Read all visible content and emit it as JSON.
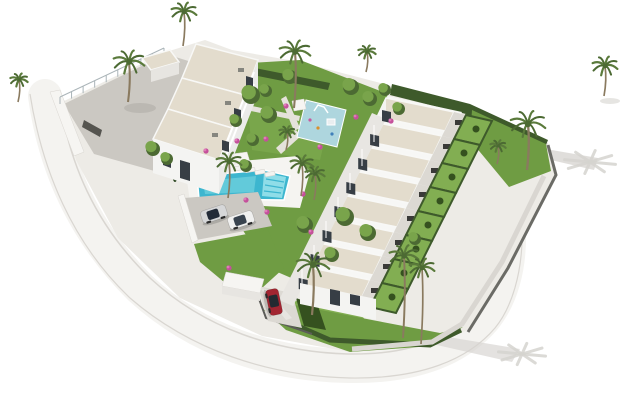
{
  "scene": {
    "description": "Aerial 3D architectural rendering of a white residential complex on a white background: a three-unit block at the top left, a diagonal row of eight townhouses with private hedged gardens on the right, a central landscaped garden with a children's playground, a turquoise communal swimming pool with sun loungers and a pergola, a grey parking area with two cars, an entrance carport with a red car, palm trees throughout, and a curved perimeter road casting palm shadows.",
    "inventory": {
      "block_a_units": 3,
      "townhouse_units": 8,
      "swimming_pools": 1,
      "playgrounds": 1,
      "cars": 3,
      "palm_trees": 15
    },
    "townhouse_row": {
      "count": 8
    },
    "block_a": {
      "units": 3
    },
    "forecourt": {
      "balustrade_posts": 10
    },
    "pool": {
      "loungers": 4
    },
    "palms": [
      [
        183,
        46,
        34,
        13
      ],
      [
        128,
        102,
        40,
        16
      ],
      [
        18,
        102,
        22,
        9
      ],
      [
        294,
        108,
        56,
        16
      ],
      [
        228,
        198,
        36,
        13
      ],
      [
        301,
        196,
        32,
        12
      ],
      [
        314,
        200,
        26,
        10
      ],
      [
        527,
        170,
        46,
        18
      ],
      [
        497,
        164,
        18,
        8
      ],
      [
        403,
        338,
        82,
        15
      ],
      [
        421,
        344,
        76,
        13
      ],
      [
        312,
        315,
        50,
        17
      ],
      [
        366,
        72,
        20,
        9
      ],
      [
        604,
        96,
        30,
        13
      ],
      [
        286,
        150,
        18,
        8
      ]
    ],
    "trees": [
      [
        250,
        94,
        9
      ],
      [
        268,
        114,
        8
      ],
      [
        289,
        76,
        7
      ],
      [
        350,
        86,
        8
      ],
      [
        369,
        98,
        7
      ],
      [
        304,
        224,
        8
      ],
      [
        344,
        216,
        9
      ],
      [
        367,
        232,
        8
      ],
      [
        252,
        139,
        6
      ],
      [
        384,
        89,
        6
      ],
      [
        331,
        254,
        7
      ],
      [
        414,
        238,
        6
      ],
      [
        152,
        148,
        7
      ],
      [
        166,
        158,
        6
      ],
      [
        398,
        108,
        6
      ],
      [
        265,
        90,
        6
      ],
      [
        235,
        120,
        6
      ],
      [
        245,
        165,
        6
      ]
    ],
    "flowers": [
      [
        237,
        141
      ],
      [
        266,
        139
      ],
      [
        320,
        147
      ],
      [
        303,
        194
      ],
      [
        206,
        151
      ],
      [
        229,
        268
      ],
      [
        286,
        106
      ],
      [
        356,
        117
      ],
      [
        391,
        121
      ],
      [
        267,
        212
      ],
      [
        246,
        200
      ],
      [
        311,
        232
      ]
    ],
    "cars": [
      {
        "name": "car-silver",
        "x": 214,
        "y": 214,
        "rot": -18,
        "body": "#d6d7d8",
        "glass": "#222b38"
      },
      {
        "name": "car-white",
        "x": 241,
        "y": 220,
        "rot": -18,
        "body": "#f0f0ef",
        "glass": "#39434e"
      },
      {
        "name": "car-red",
        "x": 274,
        "y": 302,
        "rot": 78,
        "body": "#a22531",
        "glass": "#242a31"
      }
    ]
  },
  "colors": {
    "background": "#ffffff",
    "road_surface": "#f4f3f0",
    "road_edge": "#d9d6d1",
    "site_base": "#edebe6",
    "paving": "#cbc8c2",
    "paving_light": "#dcd9d3",
    "path_grey": "#e5e2db",
    "wall_white": "#f6f5f2",
    "wall_face": "#e7e5e1",
    "gate_dark": "#55544f",
    "roof_beige": "#e3dccd",
    "roof_edge": "#f8f8f6",
    "facade_bright": "#f4f4f2",
    "facade_mid": "#ebebe9",
    "facade_low": "#e8e6e2",
    "window_dark": "#373e45",
    "lawn": "#6f9c43",
    "lawn_light": "#82ae52",
    "hedge_dark": "#3e5a2b",
    "bush_dark": "#35511f",
    "tree_dark": "#4c6a33",
    "tree_light": "#79a44b",
    "cypress": "#2e4823",
    "palm_green": "#5a7a3b",
    "palm_trunk": "#8a7a5f",
    "pool_water": "#3db6cf",
    "pool_light": "#6fd0de",
    "pool_shelf": "#8fdde8",
    "deck_white": "#f5f4f1",
    "playground_blue": "#aed6de",
    "stone_wall": "#b5a48a",
    "flower_pink": "#c4509b",
    "flower_light": "#e07ab8",
    "shadow_grey": "#d5d3cf",
    "boundary_wall": "#6b6b66",
    "fence_dark": "#5c5c58",
    "ac_grey": "#86867f",
    "glass_rail": "#aab4b8"
  }
}
